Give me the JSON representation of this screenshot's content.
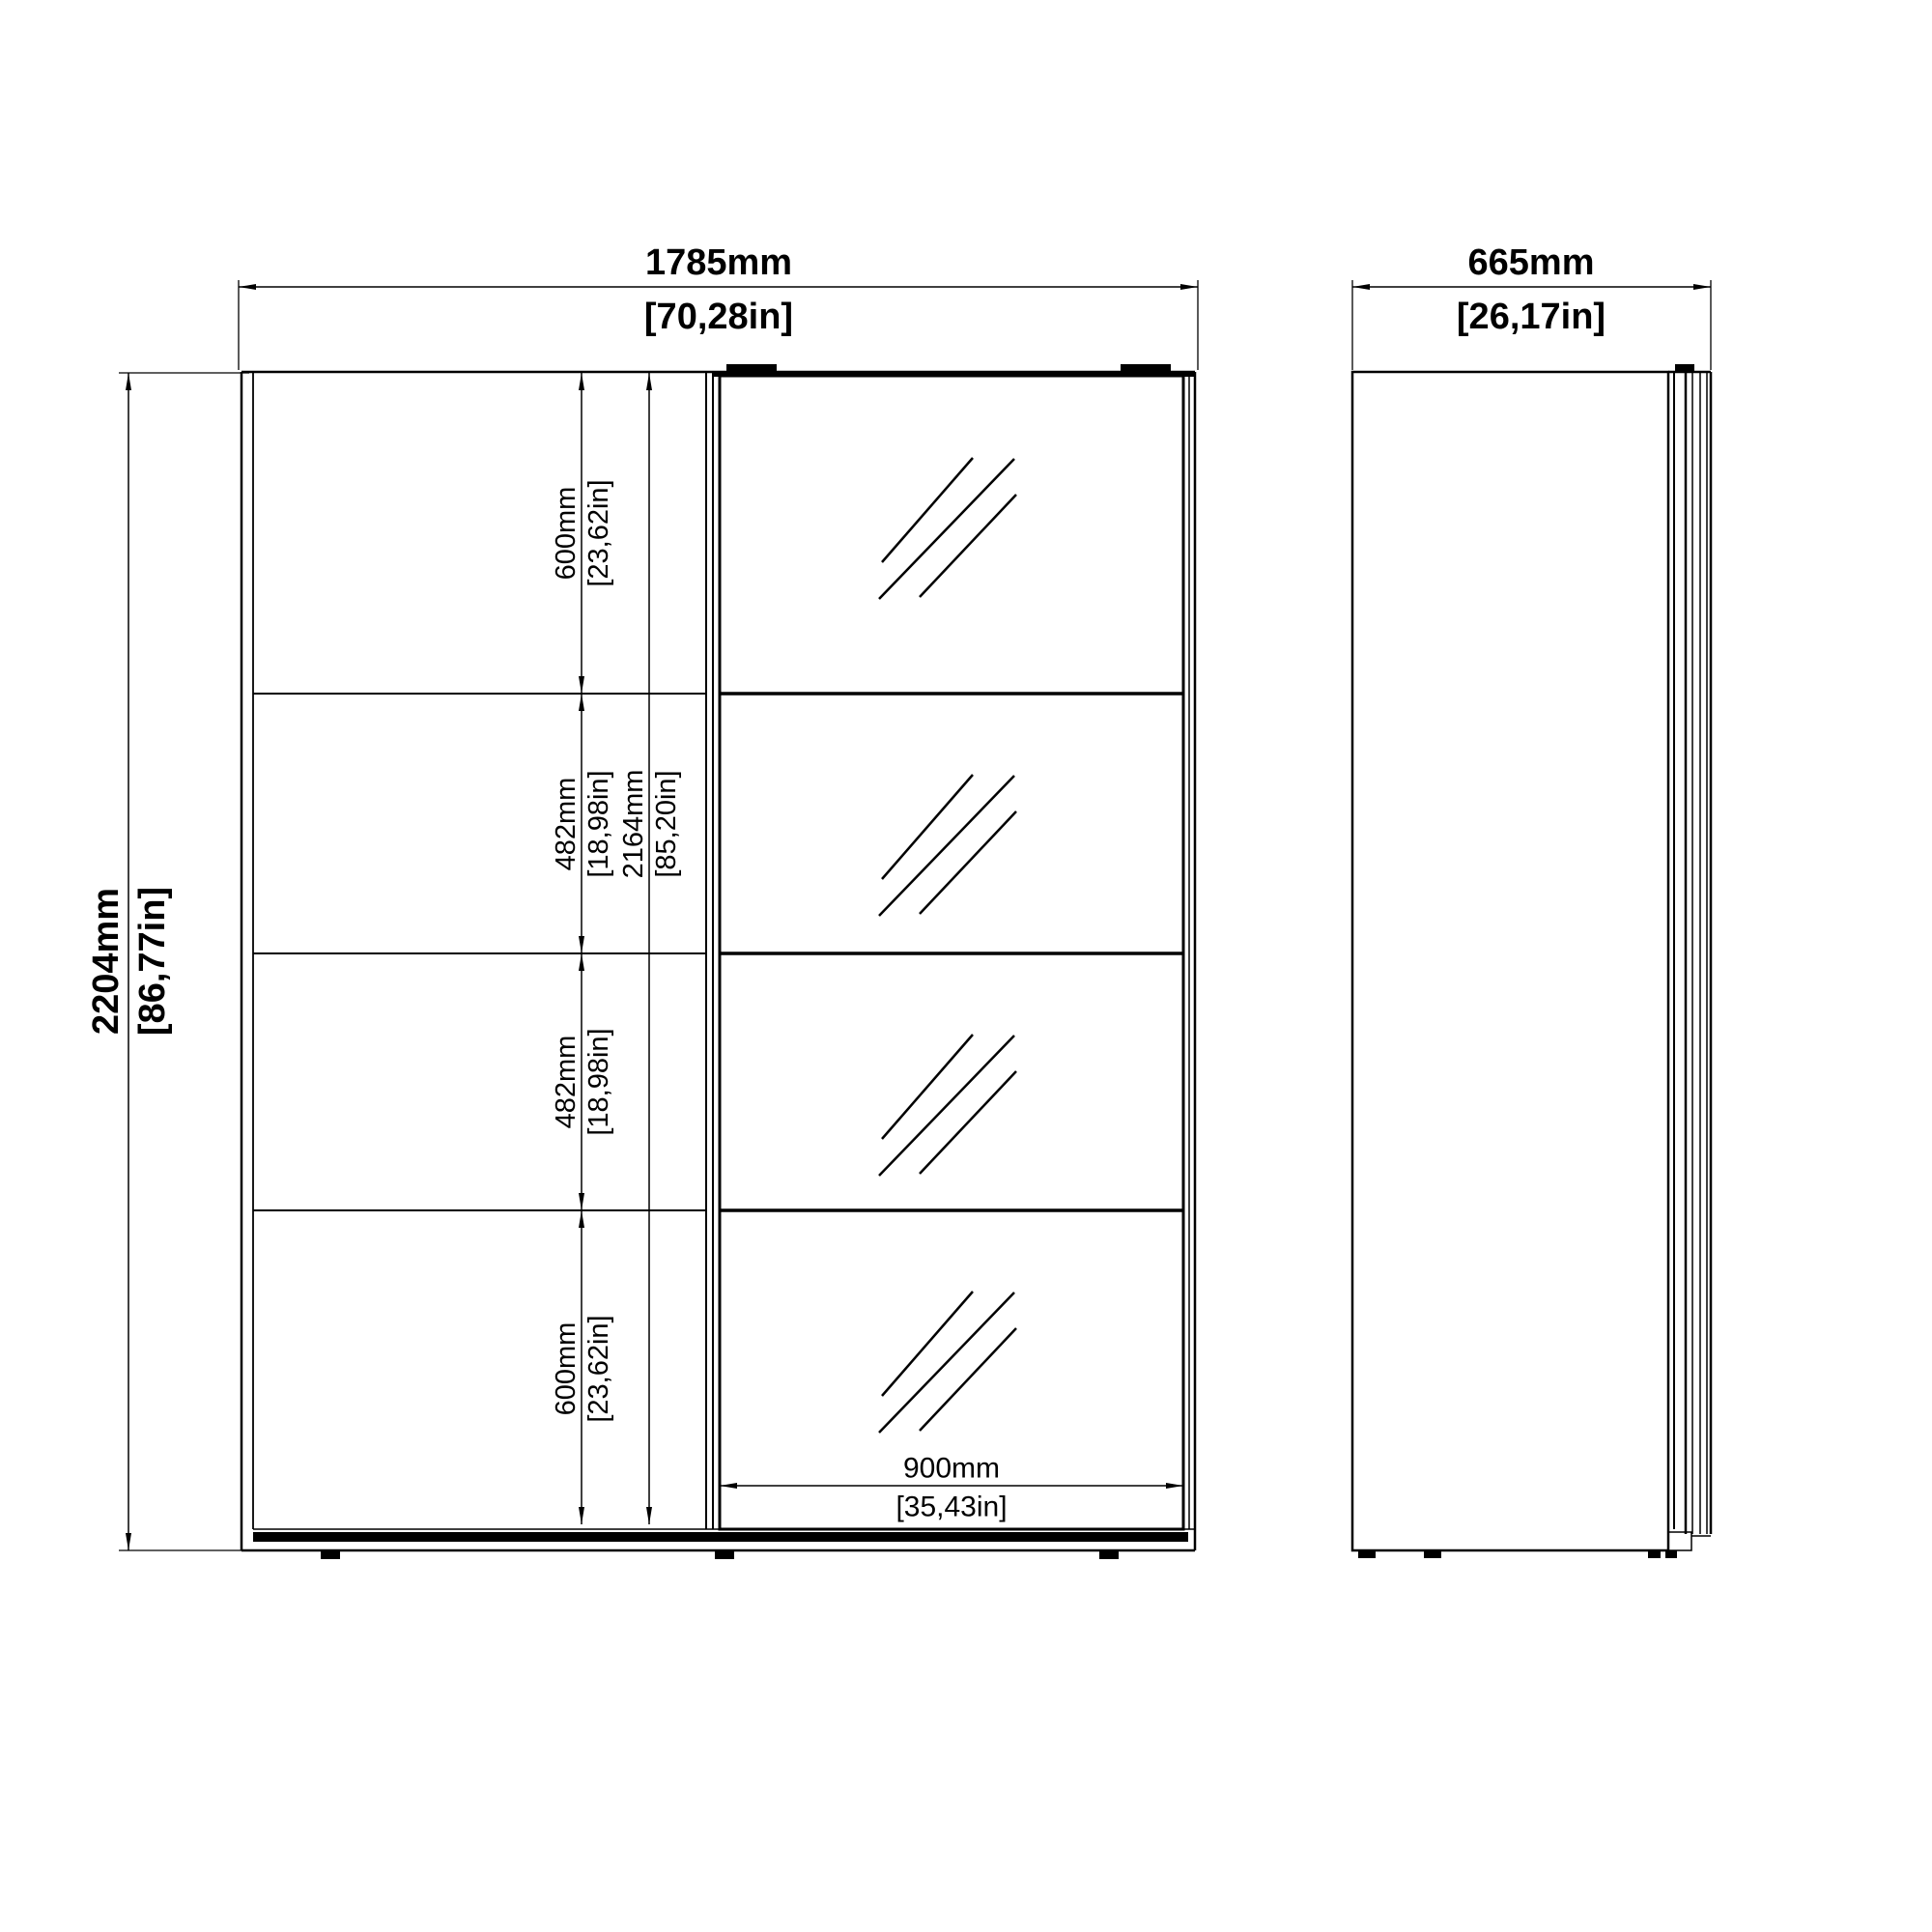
{
  "front_view": {
    "width": {
      "mm": "1785mm",
      "inch": "[70,28in]"
    },
    "height": {
      "mm": "2204mm",
      "inch": "[86,77in]"
    },
    "interior_total": {
      "mm": "2164mm",
      "inch": "[85,20in]"
    },
    "sections": [
      {
        "mm": "600mm",
        "inch": "[23,62in]"
      },
      {
        "mm": "482mm",
        "inch": "[18,98in]"
      },
      {
        "mm": "482mm",
        "inch": "[18,98in]"
      },
      {
        "mm": "600mm",
        "inch": "[23,62in]"
      }
    ],
    "door": {
      "mm": "900mm",
      "inch": "[35,43in]"
    }
  },
  "side_view": {
    "depth": {
      "mm": "665mm",
      "inch": "[26,17in]"
    }
  },
  "colors": {
    "line": "#000000",
    "background": "#ffffff"
  }
}
